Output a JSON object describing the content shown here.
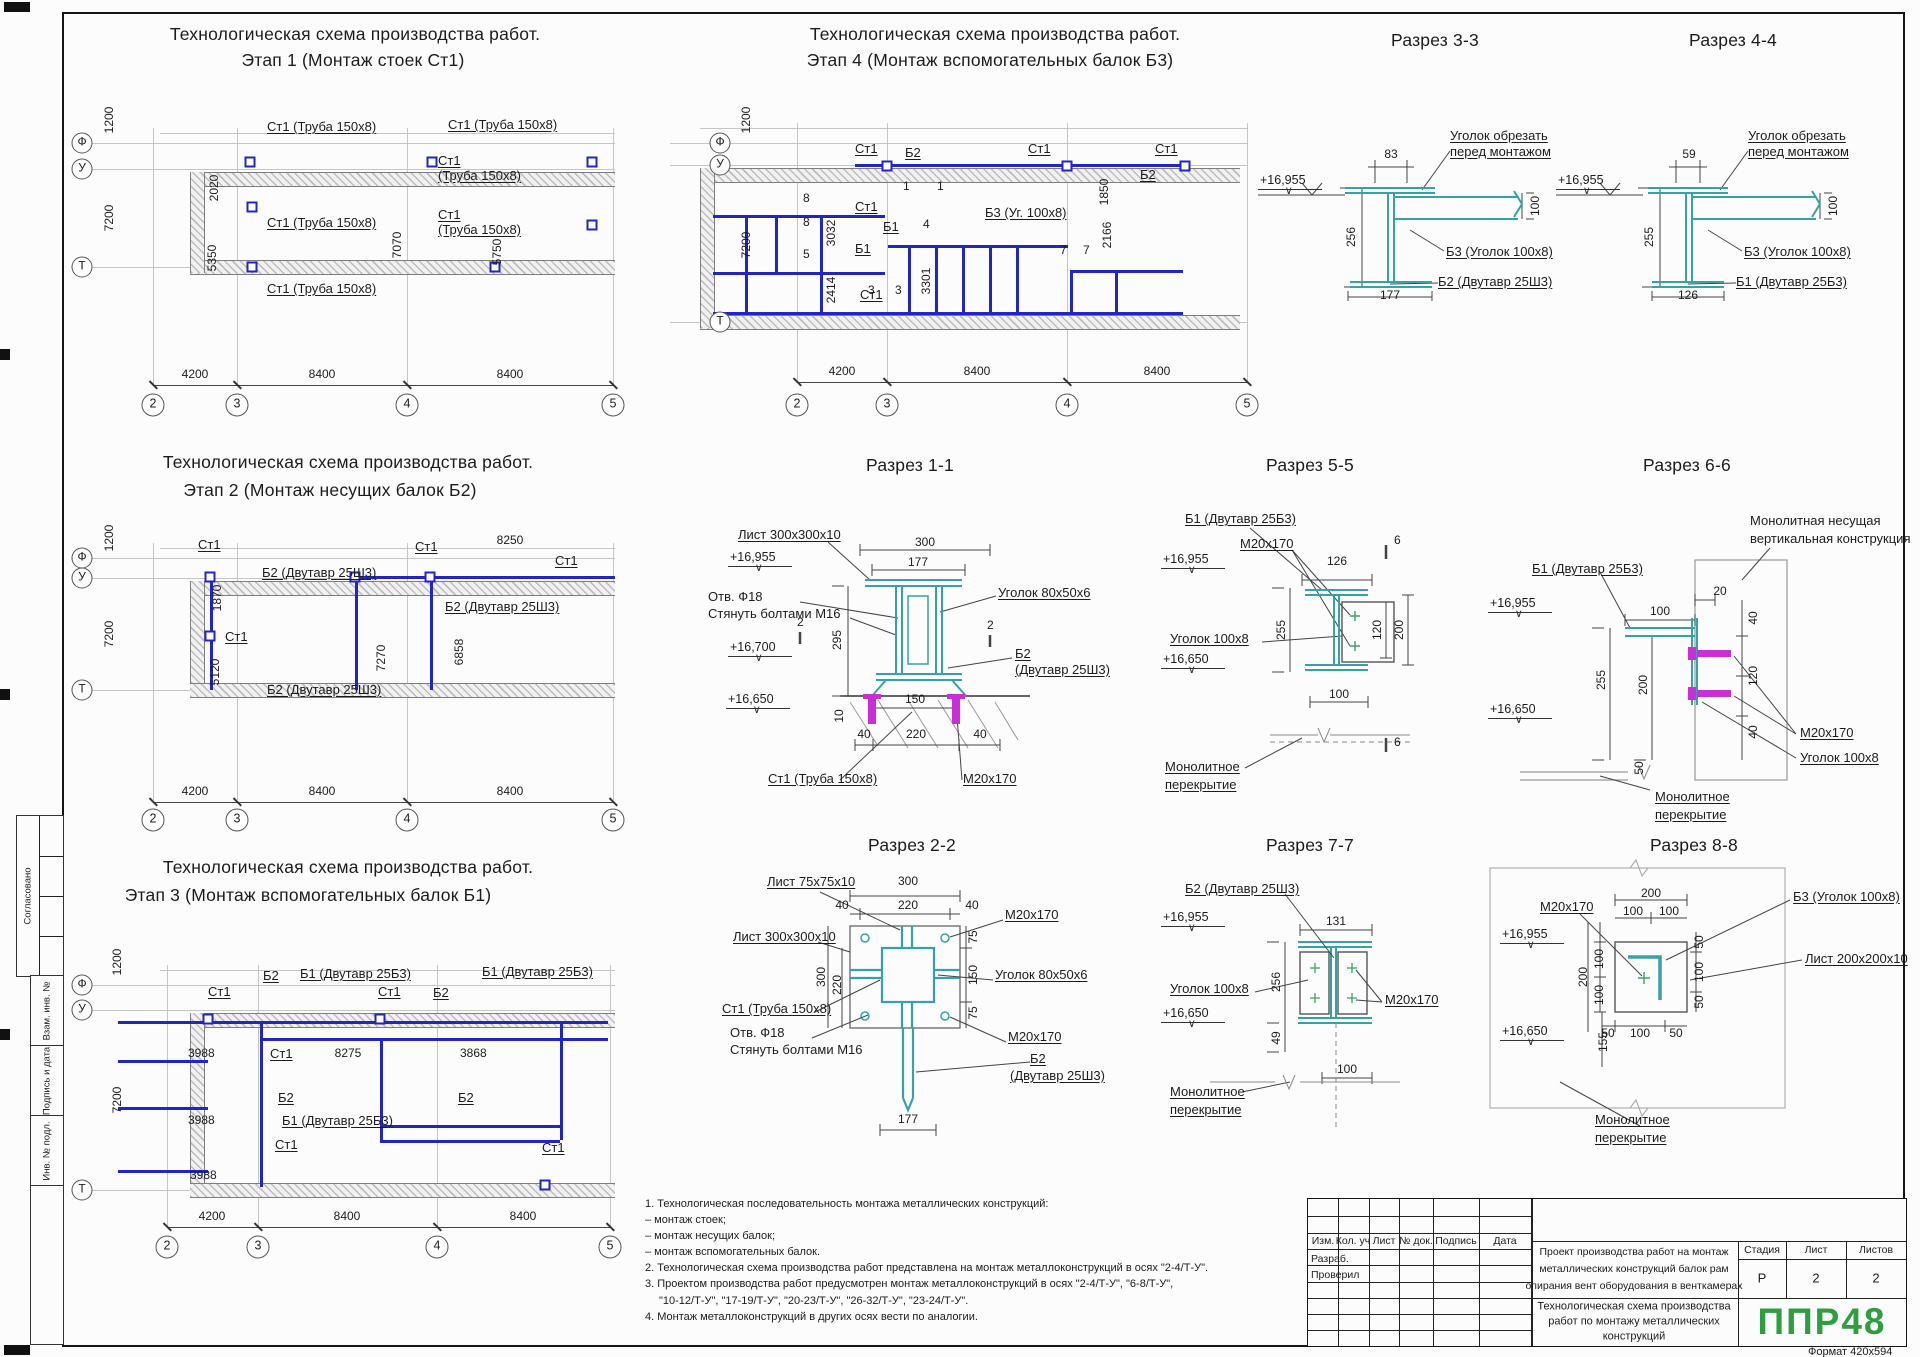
{
  "common": {
    "scheme_title": "Технологическая схема производства работ.",
    "axis_f": "Ф",
    "axis_u": "У",
    "axis_t": "Т",
    "ax2": "2",
    "ax3": "3",
    "ax4": "4",
    "ax5": "5",
    "dim_1200": "1200",
    "dim_7200": "7200",
    "dim_4200": "4200",
    "dim_8400": "8400",
    "st1": "Ст1",
    "st1_pipe": "Ст1 (Труба 150х8)",
    "pipe2": "(Труба 150х8)",
    "b1": "Б1",
    "b2": "Б2",
    "b2_beam": "Б2 (Двутавр 25Ш3)",
    "b1_beam": "Б1 (Двутавр 25Б3)",
    "b3_angle": "Б3 (Уголок 100х8)",
    "beam25sh3": "(Двутавр 25Ш3)",
    "m20": "М20х170",
    "angle100": "Уголок 100х8",
    "angle80": "Уголок 80х50х6",
    "mono1": "Монолитное",
    "mono2": "перекрытие",
    "elev_top": "+16,955",
    "elev_mid": "+16,700",
    "elev_low": "+16,650",
    "cut1": "Уголок обрезать",
    "cut2": "перед монтажом",
    "otv": "Отв. Ф18",
    "tie": "Стянуть болтами М16",
    "sheet300": "Лист 300х300х10"
  },
  "plan1": {
    "title2": "Этап 1 (Монтаж стоек Ст1)",
    "d2020": "2020",
    "d5350": "5350",
    "d7070": "7070",
    "d5750": "5750"
  },
  "plan2": {
    "title2": "Этап 2 (Монтаж несущих балок Б2)",
    "d1870": "1870",
    "d5120": "5120",
    "d7270": "7270",
    "d6858": "6858",
    "d8250": "8250"
  },
  "plan3": {
    "title2": "Этап 3 (Монтаж вспомогательных балок Б1)",
    "d3988": "3988",
    "d8275": "8275",
    "d3868": "3868"
  },
  "plan4": {
    "title2": "Этап 4 (Монтаж вспомогательных балок Б3)",
    "b3_short": "Б3 (Уг. 100х8)",
    "d3032": "3032",
    "d2414": "2414",
    "d3301": "3301",
    "d1850": "1850",
    "d2166": "2166",
    "marks": [
      "1",
      "1",
      "8",
      "8",
      "5",
      "4",
      "3",
      "3",
      "7",
      "7"
    ]
  },
  "sec33": {
    "title": "Разрез 3-3",
    "d83": "83",
    "d256": "256",
    "d100": "100",
    "d177": "177"
  },
  "sec44": {
    "title": "Разрез 4-4",
    "d59": "59",
    "d255": "255",
    "d100": "100",
    "d126": "126"
  },
  "sec11": {
    "title": "Разрез 1-1",
    "d300": "300",
    "d177": "177",
    "d295": "295",
    "d10": "10",
    "d150": "150",
    "d40": "40",
    "d220": "220",
    "mark": "2"
  },
  "sec55": {
    "title": "Разрез 5-5",
    "d126": "126",
    "d255": "255",
    "d120": "120",
    "d200": "200",
    "d100": "100",
    "mark": "6"
  },
  "sec66": {
    "title": "Разрез 6-6",
    "wall1": "Монолитная несущая",
    "wall2": "вертикальная конструкция",
    "d20": "20",
    "d100": "100",
    "d255": "255",
    "d200": "200",
    "d40": "40",
    "d120": "120",
    "d50": "50"
  },
  "sec22": {
    "title": "Разрез 2-2",
    "sheet75": "Лист 75х75х10",
    "d300": "300",
    "d220": "220",
    "d40": "40",
    "d75": "75",
    "d150": "150",
    "d177": "177"
  },
  "sec77": {
    "title": "Разрез 7-7",
    "d131": "131",
    "d256": "256",
    "d49": "49",
    "d100": "100"
  },
  "sec88": {
    "title": "Разрез 8-8",
    "sheet200": "Лист 200х200х10",
    "d200": "200",
    "d100": "100",
    "d155": "155",
    "d50": "50"
  },
  "notes": {
    "n1": "1.  Технологическая последовательность монтажа металлических конструкций:",
    "n1a": "–   монтаж стоек;",
    "n1b": "–   монтаж несущих балок;",
    "n1c": "–   монтаж вспомогательных балок.",
    "n2": "2.  Технологическая схема производства работ представлена на монтаж металлоконструкций в осях \"2-4/Т-У\".",
    "n3": "3.  Проектом производства работ предусмотрен монтаж металлоконструкций в осях \"2-4/Т-У\", \"6-8/Т-У\",",
    "n3b": "\"10-12/Т-У\", \"17-19/Т-У\", \"20-23/Т-У\", \"26-32/Т-У\", \"23-24/Т-У\".",
    "n4": "4.  Монтаж металлоконструкций в других осях вести по аналогии."
  },
  "titleblock": {
    "h_izm": "Изм.",
    "h_kol": "Кол. уч",
    "h_list": "Лист",
    "h_dok": "№ док.",
    "h_podp": "Подпись",
    "h_data": "Дата",
    "razrab": "Разраб.",
    "proveril": "Проверил",
    "project1": "Проект производства работ на монтаж",
    "project2": "металлических конструкций балок рам",
    "project3": "опирания вент оборудования в венткамерах",
    "doc1": "Технологическая схема производства",
    "doc2": "работ по монтажу металлических",
    "doc3": "конструкций",
    "h_stage": "Стадия",
    "h_sheet": "Лист",
    "h_sheets": "Листов",
    "stage": "Р",
    "sheet_no": "2",
    "sheets_total": "2",
    "logo": "ППР48",
    "format": "Формат 420х594"
  },
  "side": {
    "approved": "Согласовано",
    "vzam": "Взам. инв. №",
    "sign": "Подпись и дата",
    "inv": "Инв. № подл."
  }
}
